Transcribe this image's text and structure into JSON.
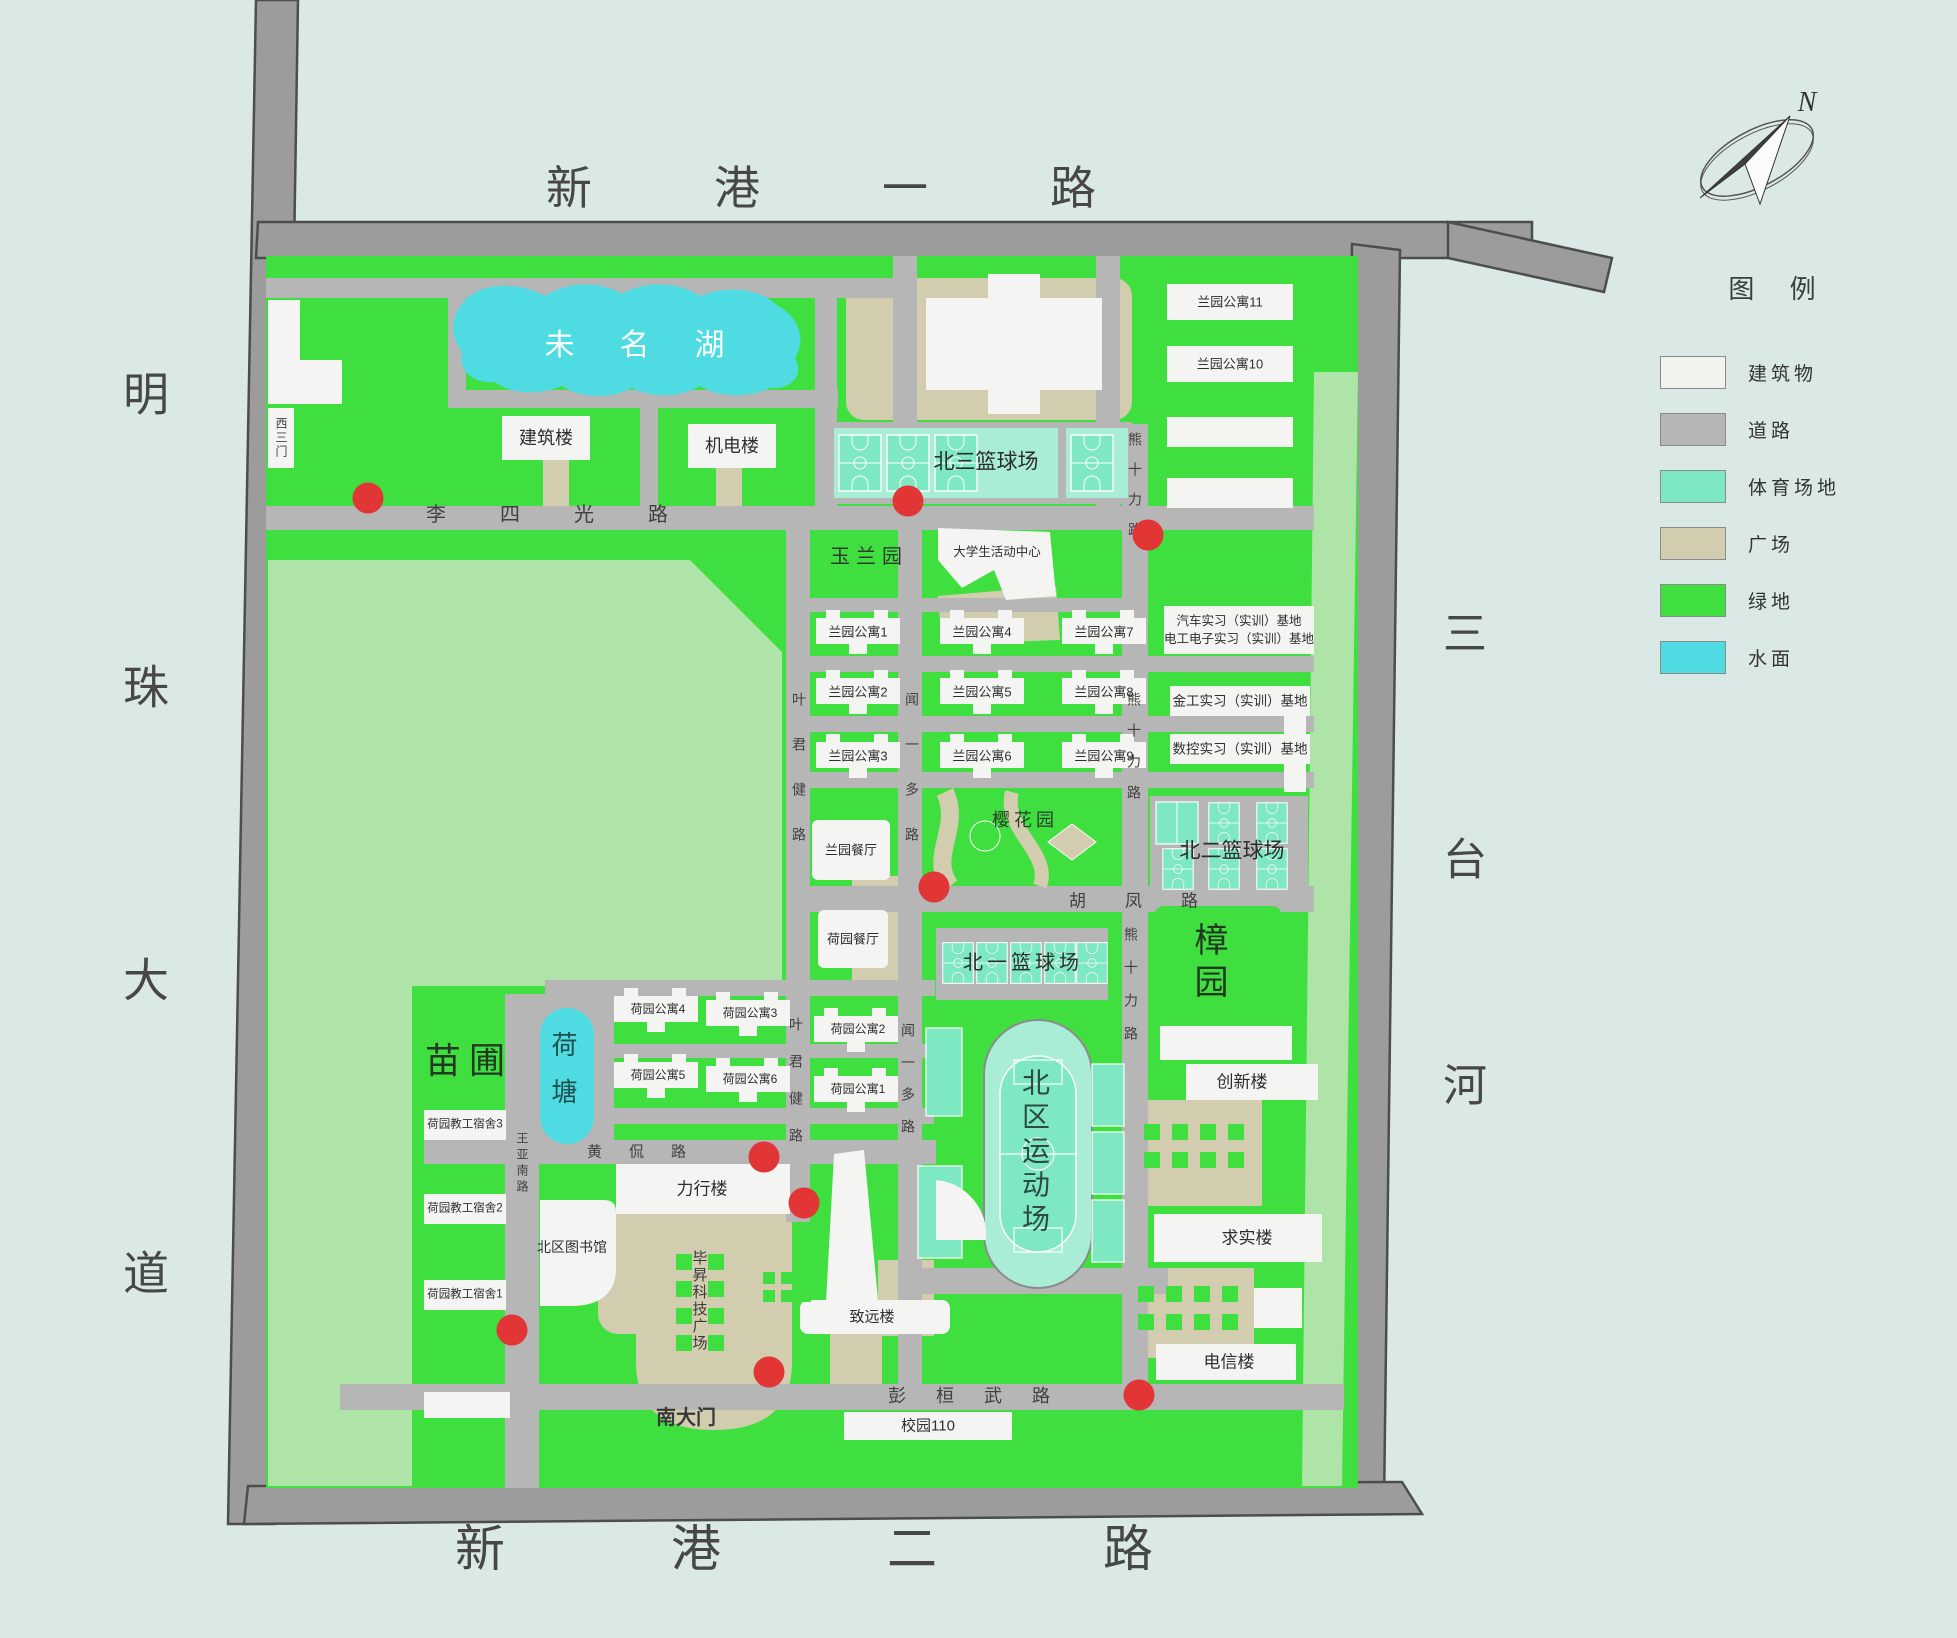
{
  "colors": {
    "background": "#dbe9e6",
    "campus_green": "#3fdf3f",
    "pale_green": "#aee4a7",
    "road_outer": "#9c9c9c",
    "road_inner": "#b6b6b6",
    "building_white": "#f4f4f2",
    "plaza_tan": "#d3cdb0",
    "sports_light": "#a9edd6",
    "sports_court": "#7de8c2",
    "water_cyan": "#4edce2",
    "marker_red": "#e23535"
  },
  "compass": {
    "north_label": "N"
  },
  "legend": {
    "title": "图  例",
    "items": [
      {
        "label": "建筑物",
        "color": "#f2f2ef"
      },
      {
        "label": "道路",
        "color": "#b6b6b6"
      },
      {
        "label": "体育场地",
        "color": "#7de8c2"
      },
      {
        "label": "广场",
        "color": "#d3cdb0"
      },
      {
        "label": "绿地",
        "color": "#3fdf3f"
      },
      {
        "label": "水面",
        "color": "#4edce2"
      }
    ]
  },
  "boundary_roads": {
    "north": "新港一路",
    "west": "明珠大道",
    "south": "新港二路",
    "river_east": "三台河"
  },
  "roads": {
    "lisiguang": "李四光路",
    "yejunjian": "叶君健路",
    "wenyiduo": "闻一多路",
    "xiongshili": "熊十力路",
    "hufeng": "胡凤路",
    "huangkan": "黄侃路",
    "wangyanan": "王亚南路",
    "penghuanwu": "彭桓武路"
  },
  "gates": {
    "west_gate3": "西三门",
    "south_gate": "南大门"
  },
  "water": {
    "lake": "未名湖",
    "pond": "荷塘"
  },
  "sports": {
    "court_north3": "北三篮球场",
    "court_north2": "北二篮球场",
    "court_north1": "北一篮球场",
    "stadium": "北区运动场"
  },
  "green_areas": {
    "yulan_garden": "玉兰园",
    "sakura_garden": "樱花园",
    "camphor_garden": "樟园",
    "nursery": "苗圃"
  },
  "buildings": {
    "jianzhu": "建筑楼",
    "jidian": "机电楼",
    "student_center": "大学生活动中心",
    "ly1": "兰园公寓1",
    "ly2": "兰园公寓2",
    "ly3": "兰园公寓3",
    "ly4": "兰园公寓4",
    "ly5": "兰园公寓5",
    "ly6": "兰园公寓6",
    "ly7": "兰园公寓7",
    "ly8": "兰园公寓8",
    "ly9": "兰园公寓9",
    "ly10": "兰园公寓10",
    "ly11": "兰园公寓11",
    "ly_canteen": "兰园餐厅",
    "hy_canteen": "荷园餐厅",
    "hy1": "荷园公寓1",
    "hy2": "荷园公寓2",
    "hy3": "荷园公寓3",
    "hy4": "荷园公寓4",
    "hy5": "荷园公寓5",
    "hy6": "荷园公寓6",
    "staff1": "荷园教工宿舍1",
    "staff2": "荷园教工宿舍2",
    "staff3": "荷园教工宿舍3",
    "base_auto": "汽车实习（实训）基地",
    "base_elec": "电工电子实习（实训）基地",
    "base_metal": "金工实习（实训）基地",
    "base_cnc": "数控实习（实训）基地",
    "lixing": "力行楼",
    "library": "北区图书馆",
    "bisheng_plaza": "毕昇科技广场",
    "zhiyuan": "致远楼",
    "chuangxin": "创新楼",
    "qiushi": "求实楼",
    "dianxin": "电信楼"
  },
  "misc": {
    "campus110": "校园110"
  }
}
